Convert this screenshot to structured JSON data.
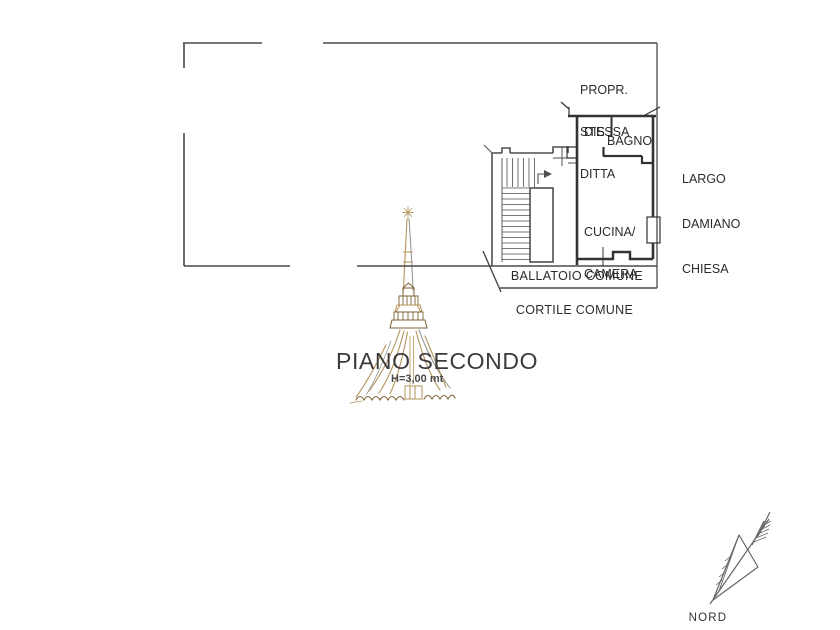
{
  "drawing": {
    "title": "PIANO SECONDO",
    "height_note": "H=3,00 mt",
    "north_label": "NORD"
  },
  "labels": {
    "adjacent_property": [
      "PROPR.",
      "STESSA",
      "DITTA"
    ],
    "street": [
      "LARGO",
      "DAMIANO",
      "CHIESA"
    ],
    "rooms": {
      "disimpegno": "DIS",
      "bathroom": "BAGNO",
      "kitchen_bedroom": [
        "CUCINA/",
        "CAMERA"
      ]
    },
    "common_areas": {
      "balcony_walkway": "BALLATOIO COMUNE",
      "courtyard": "CORTILE COMUNE"
    }
  },
  "colors": {
    "background": "#ffffff",
    "plan_line": "#4a4a4a",
    "wall_line": "#333333",
    "label_text": "#2b2b2b",
    "title_text": "#3b3b3b",
    "watermark_tan": "#b3935a",
    "watermark_brown": "#7d6233",
    "north_arrow_gray": "#666666"
  }
}
